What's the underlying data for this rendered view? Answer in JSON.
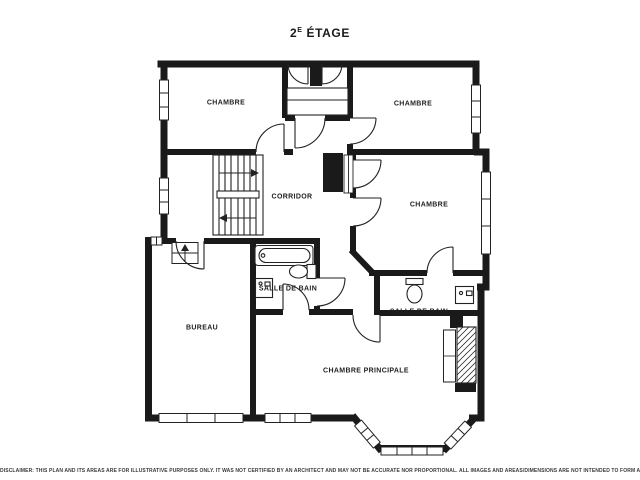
{
  "title": {
    "prefix": "2",
    "sup": "E",
    "rest": " ÉTAGE"
  },
  "floor_plan": {
    "rooms": [
      {
        "id": "chambre-1",
        "label": "CHAMBRE"
      },
      {
        "id": "chambre-2",
        "label": "CHAMBRE"
      },
      {
        "id": "corridor",
        "label": "CORRIDOR"
      },
      {
        "id": "chambre-3",
        "label": "CHAMBRE"
      },
      {
        "id": "salle-de-bain-1",
        "label": "SALLE DE BAIN"
      },
      {
        "id": "salle-de-bain-2",
        "label": "SALLE DE BAIN"
      },
      {
        "id": "bureau",
        "label": "BUREAU"
      },
      {
        "id": "chambre-principale",
        "label": "CHAMBRE PRINCIPALE"
      }
    ],
    "fixtures": [
      "staircase",
      "bathtub",
      "toilet",
      "sink",
      "bay-window",
      "hatched-closet",
      "doors",
      "windows"
    ],
    "colors": {
      "walls": "#1a1a1a",
      "background": "#ffffff",
      "text": "#1a1a1a"
    }
  },
  "disclaimer": "DISCLAIMER: THIS PLAN AND ITS AREAS ARE FOR ILLUSTRATIVE PURPOSES ONLY. IT WAS NOT CERTIFIED BY AN ARCHITECT AND MAY NOT BE ACCURATE NOR PROPORTIONAL. ALL IMAGES AND AREAS/DIMENSIONS ARE NOT INTENDED TO FORM ANY CONTRACT OR WARRANTY"
}
